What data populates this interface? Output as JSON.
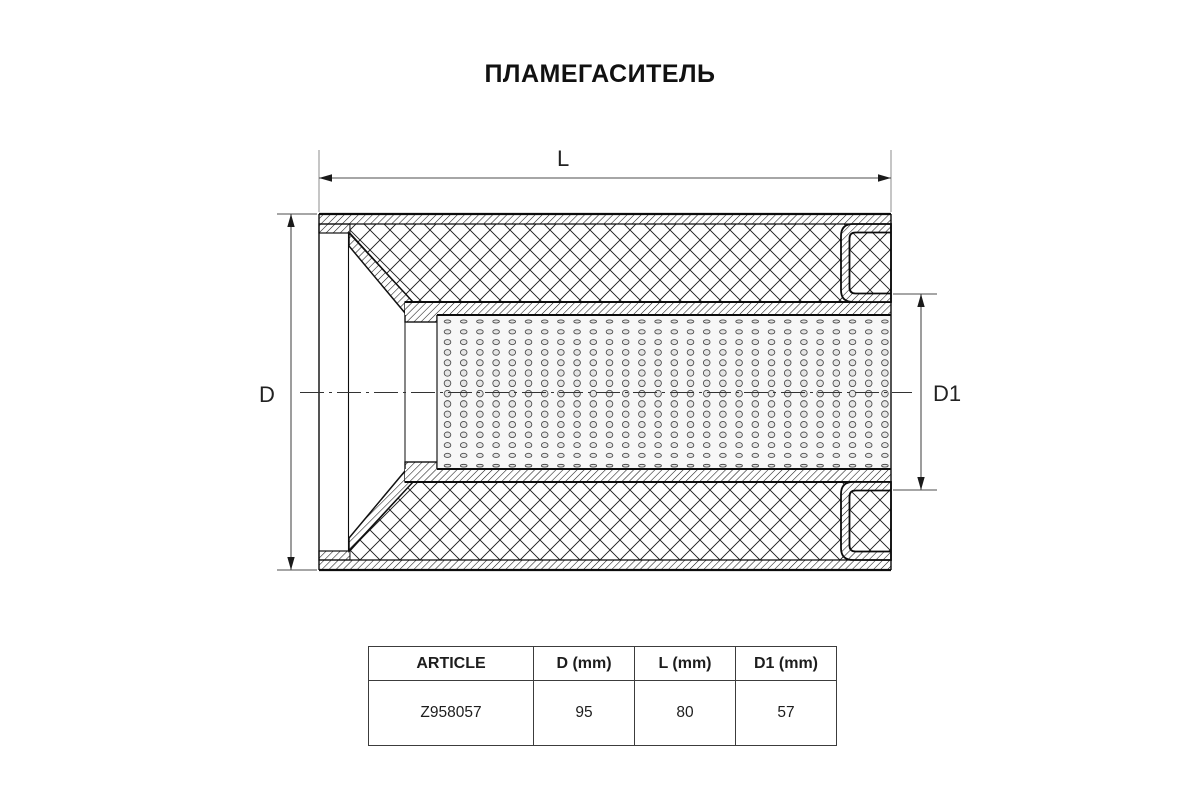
{
  "title": "ПЛАМЕГАСИТЕЛЬ",
  "drawing": {
    "labels": {
      "length": "L",
      "outer_diameter": "D",
      "inner_diameter": "D1"
    }
  },
  "table": {
    "headers": [
      "ARTICLE",
      "D (mm)",
      "L (mm)",
      "D1 (mm)"
    ],
    "rows": [
      [
        "Z958057",
        "95",
        "80",
        "57"
      ]
    ]
  },
  "colors": {
    "line": "#1a1a1a",
    "dimension_line": "#4d4d4d",
    "extension_line": "#8c8c8c",
    "perforation_fill": "#e6e6e6",
    "perforation_stroke": "#4f4f4f",
    "perforation_bg": "#f7f7f7",
    "background": "#ffffff"
  }
}
